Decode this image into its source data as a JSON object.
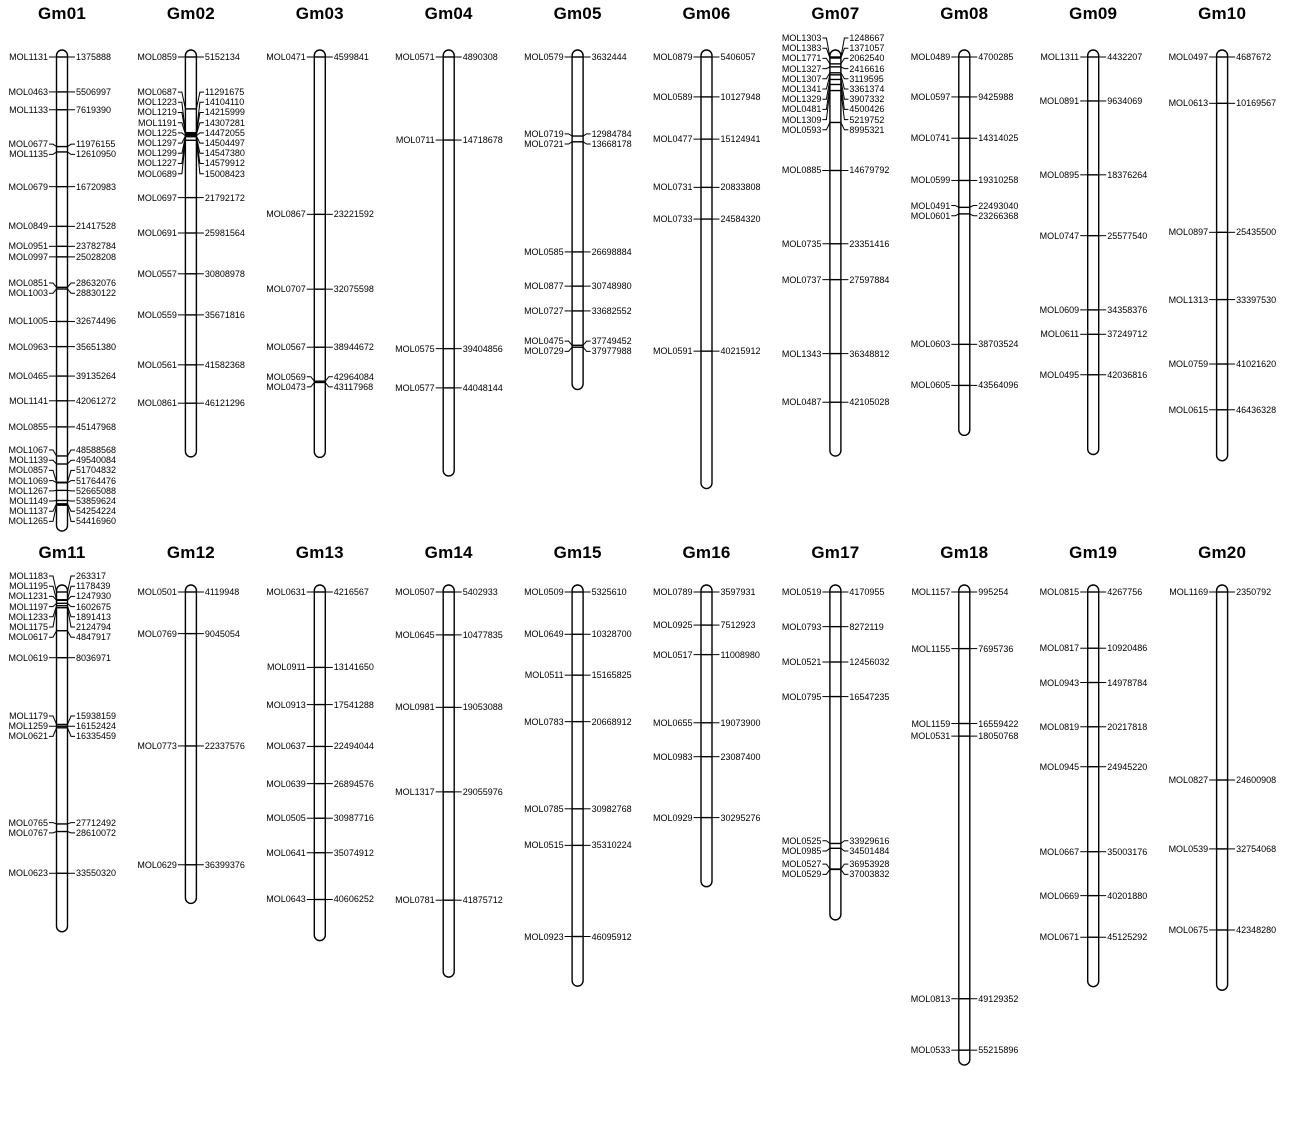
{
  "figure": {
    "background": "#ffffff",
    "foreground": "#000000",
    "description": "Chromosome map of 20 chromosomes (Gm01-Gm20) with molecular markers (left labels) and base-pair positions (right labels)"
  },
  "chromosomes": [
    {
      "name": "Gm01",
      "length_bp_est": 57000000,
      "markers": [
        {
          "name": "MOL1131",
          "pos": 1375888
        },
        {
          "name": "MOL0463",
          "pos": 5506997
        },
        {
          "name": "MOL1133",
          "pos": 7619390
        },
        {
          "name": "MOL0677",
          "pos": 11976155
        },
        {
          "name": "MOL1135",
          "pos": 12610950
        },
        {
          "name": "MOL0679",
          "pos": 16720983
        },
        {
          "name": "MOL0849",
          "pos": 21417528
        },
        {
          "name": "MOL0951",
          "pos": 23782784
        },
        {
          "name": "MOL0997",
          "pos": 25028208
        },
        {
          "name": "MOL0851",
          "pos": 28632076
        },
        {
          "name": "MOL1003",
          "pos": 28830122
        },
        {
          "name": "MOL1005",
          "pos": 32674496
        },
        {
          "name": "MOL0963",
          "pos": 35651380
        },
        {
          "name": "MOL0465",
          "pos": 39135264
        },
        {
          "name": "MOL1141",
          "pos": 42061272
        },
        {
          "name": "MOL0855",
          "pos": 45147968
        },
        {
          "name": "MOL1067",
          "pos": 48588568
        },
        {
          "name": "MOL1139",
          "pos": 49540084
        },
        {
          "name": "MOL0857",
          "pos": 51704832
        },
        {
          "name": "MOL1069",
          "pos": 51764476
        },
        {
          "name": "MOL1267",
          "pos": 52665088
        },
        {
          "name": "MOL1149",
          "pos": 53859624
        },
        {
          "name": "MOL1137",
          "pos": 54254224
        },
        {
          "name": "MOL1265",
          "pos": 54416960
        }
      ]
    },
    {
      "name": "Gm02",
      "length_bp_est": 52000000,
      "markers": [
        {
          "name": "MOL0859",
          "pos": 5152134
        },
        {
          "name": "MOL0687",
          "pos": 11291675
        },
        {
          "name": "MOL1223",
          "pos": 14104110
        },
        {
          "name": "MOL1219",
          "pos": 14215999
        },
        {
          "name": "MOL1191",
          "pos": 14307281
        },
        {
          "name": "MOL1225",
          "pos": 14472055
        },
        {
          "name": "MOL1297",
          "pos": 14504497
        },
        {
          "name": "MOL1299",
          "pos": 14547380
        },
        {
          "name": "MOL1227",
          "pos": 14579912
        },
        {
          "name": "MOL0689",
          "pos": 15008423
        },
        {
          "name": "MOL0697",
          "pos": 21792172
        },
        {
          "name": "MOL0691",
          "pos": 25981564
        },
        {
          "name": "MOL0557",
          "pos": 30808978
        },
        {
          "name": "MOL0559",
          "pos": 35671816
        },
        {
          "name": "MOL0561",
          "pos": 41582368
        },
        {
          "name": "MOL0861",
          "pos": 46121296
        }
      ]
    },
    {
      "name": "Gm03",
      "length_bp_est": 51500000,
      "markers": [
        {
          "name": "MOL0471",
          "pos": 4599841
        },
        {
          "name": "MOL0867",
          "pos": 23221592
        },
        {
          "name": "MOL0707",
          "pos": 32075598
        },
        {
          "name": "MOL0567",
          "pos": 38944672
        },
        {
          "name": "MOL0569",
          "pos": 42964084
        },
        {
          "name": "MOL0473",
          "pos": 43117968
        }
      ]
    },
    {
      "name": "Gm04",
      "length_bp_est": 54000000,
      "markers": [
        {
          "name": "MOL0571",
          "pos": 4890308
        },
        {
          "name": "MOL0711",
          "pos": 14718678
        },
        {
          "name": "MOL0575",
          "pos": 39404856
        },
        {
          "name": "MOL0577",
          "pos": 44048144
        }
      ]
    },
    {
      "name": "Gm05",
      "length_bp_est": 42500000,
      "markers": [
        {
          "name": "MOL0579",
          "pos": 3632444
        },
        {
          "name": "MOL0719",
          "pos": 12984784
        },
        {
          "name": "MOL0721",
          "pos": 13668178
        },
        {
          "name": "MOL0585",
          "pos": 26698884
        },
        {
          "name": "MOL0877",
          "pos": 30748980
        },
        {
          "name": "MOL0727",
          "pos": 33682552
        },
        {
          "name": "MOL0475",
          "pos": 37749452
        },
        {
          "name": "MOL0729",
          "pos": 37977988
        }
      ]
    },
    {
      "name": "Gm06",
      "length_bp_est": 56000000,
      "markers": [
        {
          "name": "MOL0879",
          "pos": 5406057
        },
        {
          "name": "MOL0589",
          "pos": 10127948
        },
        {
          "name": "MOL0477",
          "pos": 15124941
        },
        {
          "name": "MOL0731",
          "pos": 20833808
        },
        {
          "name": "MOL0733",
          "pos": 24584320
        },
        {
          "name": "MOL0591",
          "pos": 40215912
        }
      ]
    },
    {
      "name": "Gm07",
      "length_bp_est": 48000000,
      "markers": [
        {
          "name": "MOL1303",
          "pos": 1248667
        },
        {
          "name": "MOL1383",
          "pos": 1371057
        },
        {
          "name": "MOL1771",
          "pos": 2062540
        },
        {
          "name": "MOL1327",
          "pos": 2416616
        },
        {
          "name": "MOL1307",
          "pos": 3119595
        },
        {
          "name": "MOL1341",
          "pos": 3361374
        },
        {
          "name": "MOL1329",
          "pos": 3907332
        },
        {
          "name": "MOL0481",
          "pos": 4500426
        },
        {
          "name": "MOL1309",
          "pos": 5219752
        },
        {
          "name": "MOL0593",
          "pos": 8995321
        },
        {
          "name": "MOL0885",
          "pos": 14679792
        },
        {
          "name": "MOL0735",
          "pos": 23351416
        },
        {
          "name": "MOL0737",
          "pos": 27597884
        },
        {
          "name": "MOL1343",
          "pos": 36348812
        },
        {
          "name": "MOL0487",
          "pos": 42105028
        }
      ]
    },
    {
      "name": "Gm08",
      "length_bp_est": 49000000,
      "markers": [
        {
          "name": "MOL0489",
          "pos": 4700285
        },
        {
          "name": "MOL0597",
          "pos": 9425988
        },
        {
          "name": "MOL0741",
          "pos": 14314025
        },
        {
          "name": "MOL0599",
          "pos": 19310258
        },
        {
          "name": "MOL0491",
          "pos": 22493040
        },
        {
          "name": "MOL0601",
          "pos": 23266368
        },
        {
          "name": "MOL0603",
          "pos": 38703524
        },
        {
          "name": "MOL0605",
          "pos": 43564096
        }
      ]
    },
    {
      "name": "Gm09",
      "length_bp_est": 51000000,
      "markers": [
        {
          "name": "MOL1311",
          "pos": 4432207
        },
        {
          "name": "MOL0891",
          "pos": 9634069
        },
        {
          "name": "MOL0895",
          "pos": 18376264
        },
        {
          "name": "MOL0747",
          "pos": 25577540
        },
        {
          "name": "MOL0609",
          "pos": 34358376
        },
        {
          "name": "MOL0611",
          "pos": 37249712
        },
        {
          "name": "MOL0495",
          "pos": 42036816
        }
      ]
    },
    {
      "name": "Gm10",
      "length_bp_est": 52000000,
      "markers": [
        {
          "name": "MOL0497",
          "pos": 4687672
        },
        {
          "name": "MOL0613",
          "pos": 10169567
        },
        {
          "name": "MOL0897",
          "pos": 25435500
        },
        {
          "name": "MOL1313",
          "pos": 33397530
        },
        {
          "name": "MOL0759",
          "pos": 41021620
        },
        {
          "name": "MOL0615",
          "pos": 46436328
        }
      ]
    },
    {
      "name": "Gm11",
      "length_bp_est": 40000000,
      "markers": [
        {
          "name": "MOL1183",
          "pos": 263317
        },
        {
          "name": "MOL1195",
          "pos": 1178439
        },
        {
          "name": "MOL1231",
          "pos": 1247930
        },
        {
          "name": "MOL1197",
          "pos": 1602675
        },
        {
          "name": "MOL1233",
          "pos": 1891413
        },
        {
          "name": "MOL1175",
          "pos": 2124794
        },
        {
          "name": "MOL0617",
          "pos": 4847917
        },
        {
          "name": "MOL0619",
          "pos": 8036971
        },
        {
          "name": "MOL1179",
          "pos": 15938159
        },
        {
          "name": "MOL1259",
          "pos": 16152424
        },
        {
          "name": "MOL0621",
          "pos": 16335459
        },
        {
          "name": "MOL0765",
          "pos": 27712492
        },
        {
          "name": "MOL0767",
          "pos": 28610072
        },
        {
          "name": "MOL0623",
          "pos": 33550320
        }
      ]
    },
    {
      "name": "Gm12",
      "length_bp_est": 40500000,
      "markers": [
        {
          "name": "MOL0501",
          "pos": 4119948
        },
        {
          "name": "MOL0769",
          "pos": 9045054
        },
        {
          "name": "MOL0773",
          "pos": 22337576
        },
        {
          "name": "MOL0629",
          "pos": 36399376
        }
      ]
    },
    {
      "name": "Gm13",
      "length_bp_est": 45000000,
      "markers": [
        {
          "name": "MOL0631",
          "pos": 4216567
        },
        {
          "name": "MOL0911",
          "pos": 13141650
        },
        {
          "name": "MOL0913",
          "pos": 17541288
        },
        {
          "name": "MOL0637",
          "pos": 22494044
        },
        {
          "name": "MOL0639",
          "pos": 26894576
        },
        {
          "name": "MOL0505",
          "pos": 30987716
        },
        {
          "name": "MOL0641",
          "pos": 35074912
        },
        {
          "name": "MOL0643",
          "pos": 40606252
        }
      ]
    },
    {
      "name": "Gm14",
      "length_bp_est": 50500000,
      "markers": [
        {
          "name": "MOL0507",
          "pos": 5402933
        },
        {
          "name": "MOL0645",
          "pos": 10477835
        },
        {
          "name": "MOL0981",
          "pos": 19053088
        },
        {
          "name": "MOL1317",
          "pos": 29055976
        },
        {
          "name": "MOL0781",
          "pos": 41875712
        }
      ]
    },
    {
      "name": "Gm15",
      "length_bp_est": 51500000,
      "markers": [
        {
          "name": "MOL0509",
          "pos": 5325610
        },
        {
          "name": "MOL0649",
          "pos": 10328700
        },
        {
          "name": "MOL0511",
          "pos": 15165825
        },
        {
          "name": "MOL0783",
          "pos": 20668912
        },
        {
          "name": "MOL0785",
          "pos": 30982768
        },
        {
          "name": "MOL0515",
          "pos": 35310224
        },
        {
          "name": "MOL0923",
          "pos": 46095912
        }
      ]
    },
    {
      "name": "Gm16",
      "length_bp_est": 38000000,
      "markers": [
        {
          "name": "MOL0789",
          "pos": 3597931
        },
        {
          "name": "MOL0925",
          "pos": 7512923
        },
        {
          "name": "MOL0517",
          "pos": 11008980
        },
        {
          "name": "MOL0655",
          "pos": 19073900
        },
        {
          "name": "MOL0983",
          "pos": 23087400
        },
        {
          "name": "MOL0929",
          "pos": 30295276
        }
      ]
    },
    {
      "name": "Gm17",
      "length_bp_est": 42500000,
      "markers": [
        {
          "name": "MOL0519",
          "pos": 4170955
        },
        {
          "name": "MOL0793",
          "pos": 8272119
        },
        {
          "name": "MOL0521",
          "pos": 12456032
        },
        {
          "name": "MOL0795",
          "pos": 16547235
        },
        {
          "name": "MOL0525",
          "pos": 33929616
        },
        {
          "name": "MOL0985",
          "pos": 34501484
        },
        {
          "name": "MOL0527",
          "pos": 36953928
        },
        {
          "name": "MOL0529",
          "pos": 37003832
        }
      ]
    },
    {
      "name": "Gm18",
      "length_bp_est": 56500000,
      "markers": [
        {
          "name": "MOL1157",
          "pos": 995254
        },
        {
          "name": "MOL1155",
          "pos": 7695736
        },
        {
          "name": "MOL1159",
          "pos": 16559422
        },
        {
          "name": "MOL0531",
          "pos": 18050768
        },
        {
          "name": "MOL0813",
          "pos": 49129352
        },
        {
          "name": "MOL0533",
          "pos": 55215896
        }
      ]
    },
    {
      "name": "Gm19",
      "length_bp_est": 50500000,
      "markers": [
        {
          "name": "MOL0815",
          "pos": 4267756
        },
        {
          "name": "MOL0817",
          "pos": 10920486
        },
        {
          "name": "MOL0943",
          "pos": 14978784
        },
        {
          "name": "MOL0819",
          "pos": 20217818
        },
        {
          "name": "MOL0945",
          "pos": 24945220
        },
        {
          "name": "MOL0667",
          "pos": 35003176
        },
        {
          "name": "MOL0669",
          "pos": 40201880
        },
        {
          "name": "MOL0671",
          "pos": 45125292
        }
      ]
    },
    {
      "name": "Gm20",
      "length_bp_est": 49000000,
      "markers": [
        {
          "name": "MOL1169",
          "pos": 2350792
        },
        {
          "name": "MOL0827",
          "pos": 24600908
        },
        {
          "name": "MOL0539",
          "pos": 32754068
        },
        {
          "name": "MOL0675",
          "pos": 42348280
        }
      ]
    }
  ]
}
